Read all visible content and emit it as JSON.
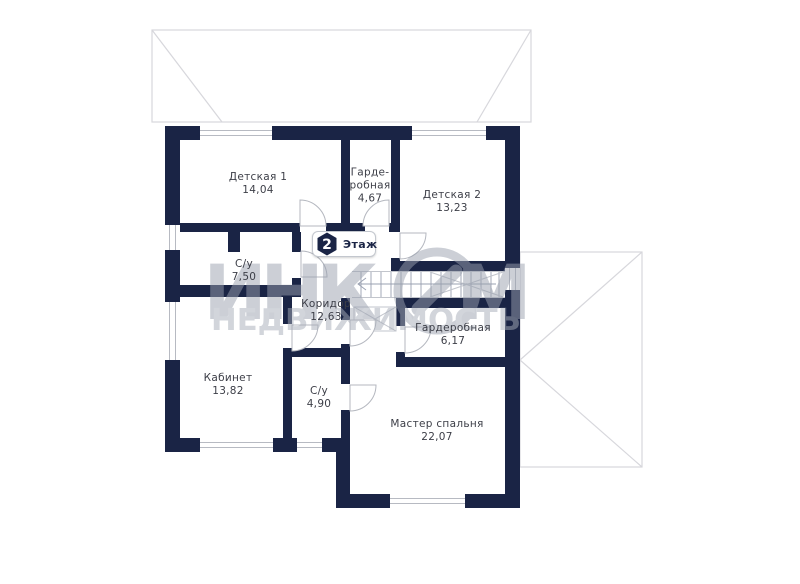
{
  "floor_badge": {
    "number": "2",
    "label": "Этаж"
  },
  "watermark": {
    "letter_i": "И",
    "letter_n": "Н",
    "letter_k": "К",
    "letter_m": "М",
    "subtitle": "НЕДВИЖИМОСТЬ"
  },
  "rooms": [
    {
      "id": "detskaya-1",
      "line1": "Детская 1",
      "line2": "14,04"
    },
    {
      "id": "garderobnaya-top",
      "line1": "Гарде-",
      "line2": "робная",
      "line3": "4,67"
    },
    {
      "id": "detskaya-2",
      "line1": "Детская 2",
      "line2": "13,23"
    },
    {
      "id": "su-7-50",
      "line1": "С/у",
      "line2": "7,50"
    },
    {
      "id": "koridor",
      "line1": "Коридор",
      "line2": "12,63"
    },
    {
      "id": "garderobnaya-master",
      "line1": "Гардеробная",
      "line2": "6,17"
    },
    {
      "id": "kabinet",
      "line1": "Кабинет",
      "line2": "13,82"
    },
    {
      "id": "su-4-90",
      "line1": "С/у",
      "line2": "4,90"
    },
    {
      "id": "master-spalnya",
      "line1": "Мастер спальня",
      "line2": "22,07"
    }
  ],
  "colors": {
    "wall": "#1a2445",
    "roof_line": "#d7d7dc",
    "watermark": "#9aa1af"
  }
}
